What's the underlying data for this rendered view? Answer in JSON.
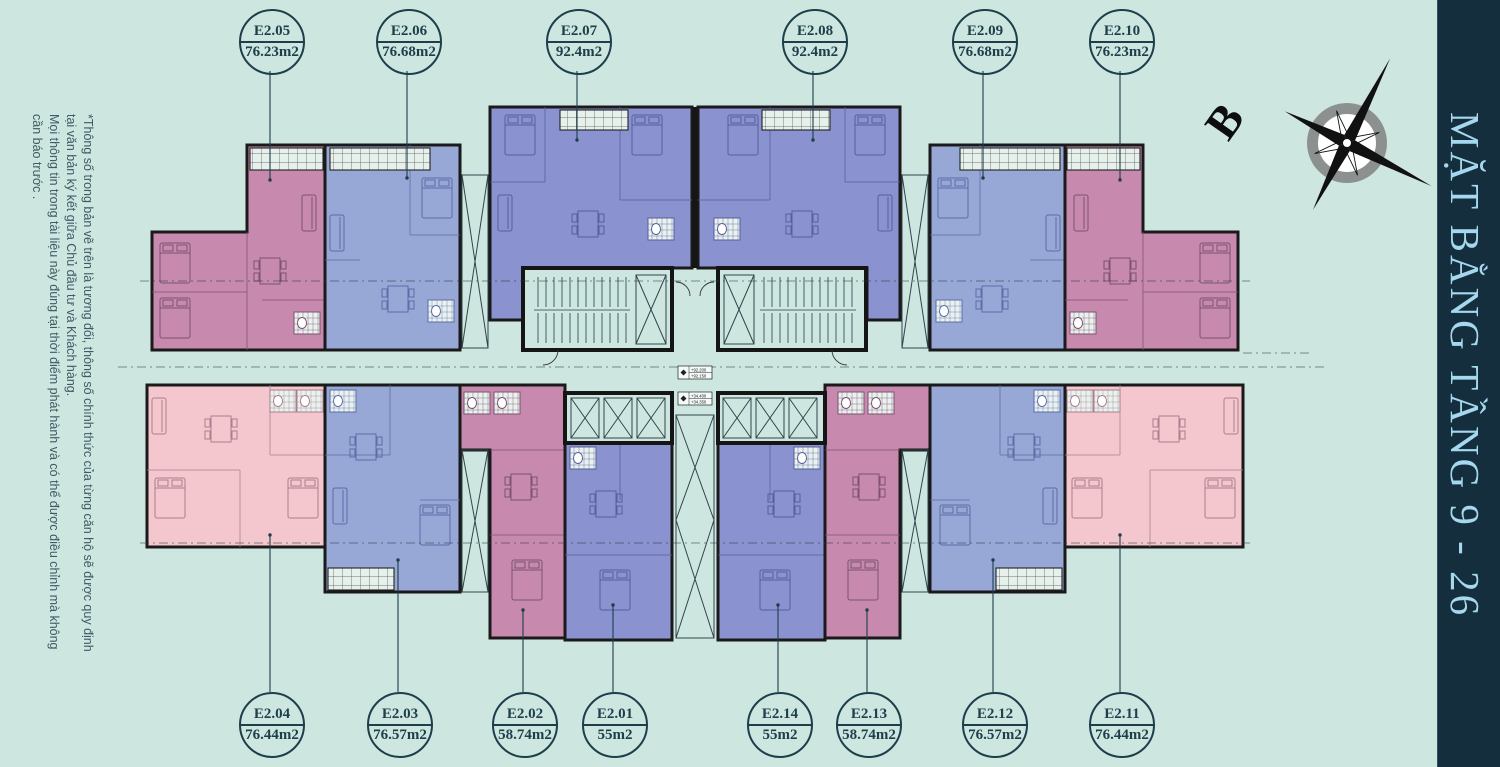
{
  "title": {
    "text": "MẶT BẰNG TẦNG 9 - 26"
  },
  "compass": {
    "north_label": "B"
  },
  "disclaimer": {
    "lines": [
      "*Thông số trong bản vẽ trên là tương đối, thông số chính thức của từng căn hộ sẽ được quy định",
      "tại văn bản ký kết giữa Chủ đầu tư và Khách hàng.",
      "Mọi thông tin trong tài liệu này đúng tại thời điểm phát hành và có thể được điều chỉnh mà không",
      "cần báo trước ."
    ]
  },
  "level_markers": {
    "upper": [
      "+92.200",
      "+92.150"
    ],
    "lower": [
      "+34.400",
      "+34.350"
    ]
  },
  "units": [
    {
      "id": "E2.05",
      "area": "76.23m2",
      "color": "mauve"
    },
    {
      "id": "E2.06",
      "area": "76.68m2",
      "color": "periwinkle"
    },
    {
      "id": "E2.07",
      "area": "92.4m2",
      "color": "purple"
    },
    {
      "id": "E2.08",
      "area": "92.4m2",
      "color": "purple"
    },
    {
      "id": "E2.09",
      "area": "76.68m2",
      "color": "periwinkle"
    },
    {
      "id": "E2.10",
      "area": "76.23m2",
      "color": "mauve"
    },
    {
      "id": "E2.04",
      "area": "76.44m2",
      "color": "pink"
    },
    {
      "id": "E2.03",
      "area": "76.57m2",
      "color": "periwinkle"
    },
    {
      "id": "E2.02",
      "area": "58.74m2",
      "color": "mauve"
    },
    {
      "id": "E2.01",
      "area": "55m2",
      "color": "purple"
    },
    {
      "id": "E2.14",
      "area": "55m2",
      "color": "purple"
    },
    {
      "id": "E2.13",
      "area": "58.74m2",
      "color": "mauve"
    },
    {
      "id": "E2.12",
      "area": "76.57m2",
      "color": "periwinkle"
    },
    {
      "id": "E2.11",
      "area": "76.44m2",
      "color": "pink"
    }
  ],
  "colors": {
    "background_mint": "#cde7e0",
    "mauve": "#c78aae",
    "periwinkle": "#97a7d6",
    "purple": "#8a92cf",
    "pink": "#f4c6cd",
    "wall": "#1a1a1a",
    "label_teal": "#1d3e4a",
    "title_strip_navy": "#142e3d",
    "title_text_blue": "#a5d8ee"
  }
}
